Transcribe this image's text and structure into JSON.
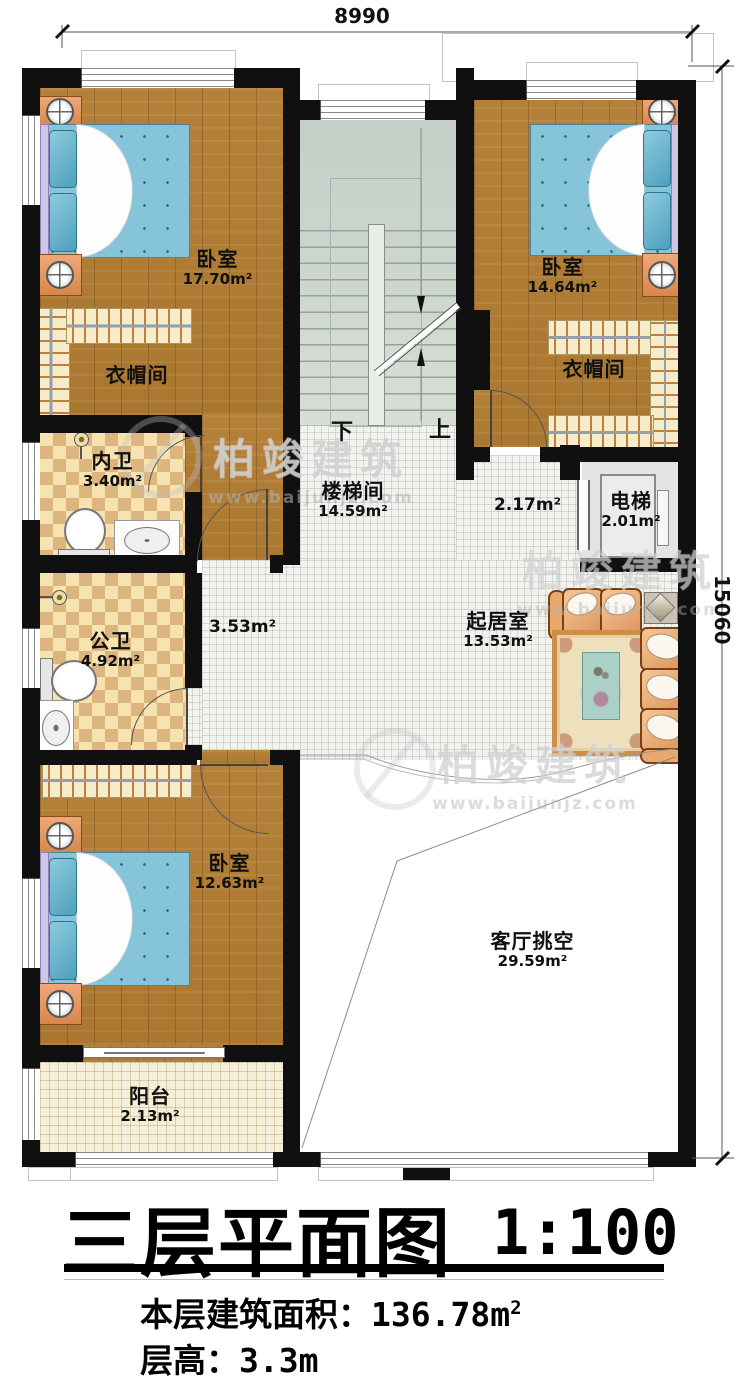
{
  "dimensions": {
    "width_top": "8990",
    "height_right": "15060"
  },
  "stairs": {
    "down_label": "下",
    "up_label": "上"
  },
  "rooms": {
    "bedroom_tl": {
      "name": "卧室",
      "area": "17.70m²"
    },
    "bedroom_tr": {
      "name": "卧室",
      "area": "14.64m²"
    },
    "bedroom_b": {
      "name": "卧室",
      "area": "12.63m²"
    },
    "closet_l": {
      "name": "衣帽间"
    },
    "closet_r": {
      "name": "衣帽间"
    },
    "bath_inner": {
      "name": "内卫",
      "area": "3.40m²"
    },
    "bath_public": {
      "name": "公卫",
      "area": "4.92m²"
    },
    "stairwell": {
      "name": "楼梯间",
      "area": "14.59m²"
    },
    "hall": {
      "area": "3.53m²"
    },
    "corridor": {
      "area": "2.17m²"
    },
    "elevator": {
      "name": "电梯",
      "area": "2.01m²"
    },
    "living": {
      "name": "起居室",
      "area": "13.53m²"
    },
    "void": {
      "name": "客厅挑空",
      "area": "29.59m²"
    },
    "balcony": {
      "name": "阳台",
      "area": "2.13m²"
    }
  },
  "title": {
    "main": "三层平面图",
    "scale": "1:100",
    "area_label": "本层建筑面积：",
    "area_value": "136.78m",
    "area_superscript": "2",
    "floor_height_label": "层高：",
    "floor_height_value": "3.3m"
  },
  "watermark": {
    "brand": "柏竣建筑",
    "url": "www.baijunjz.com"
  }
}
